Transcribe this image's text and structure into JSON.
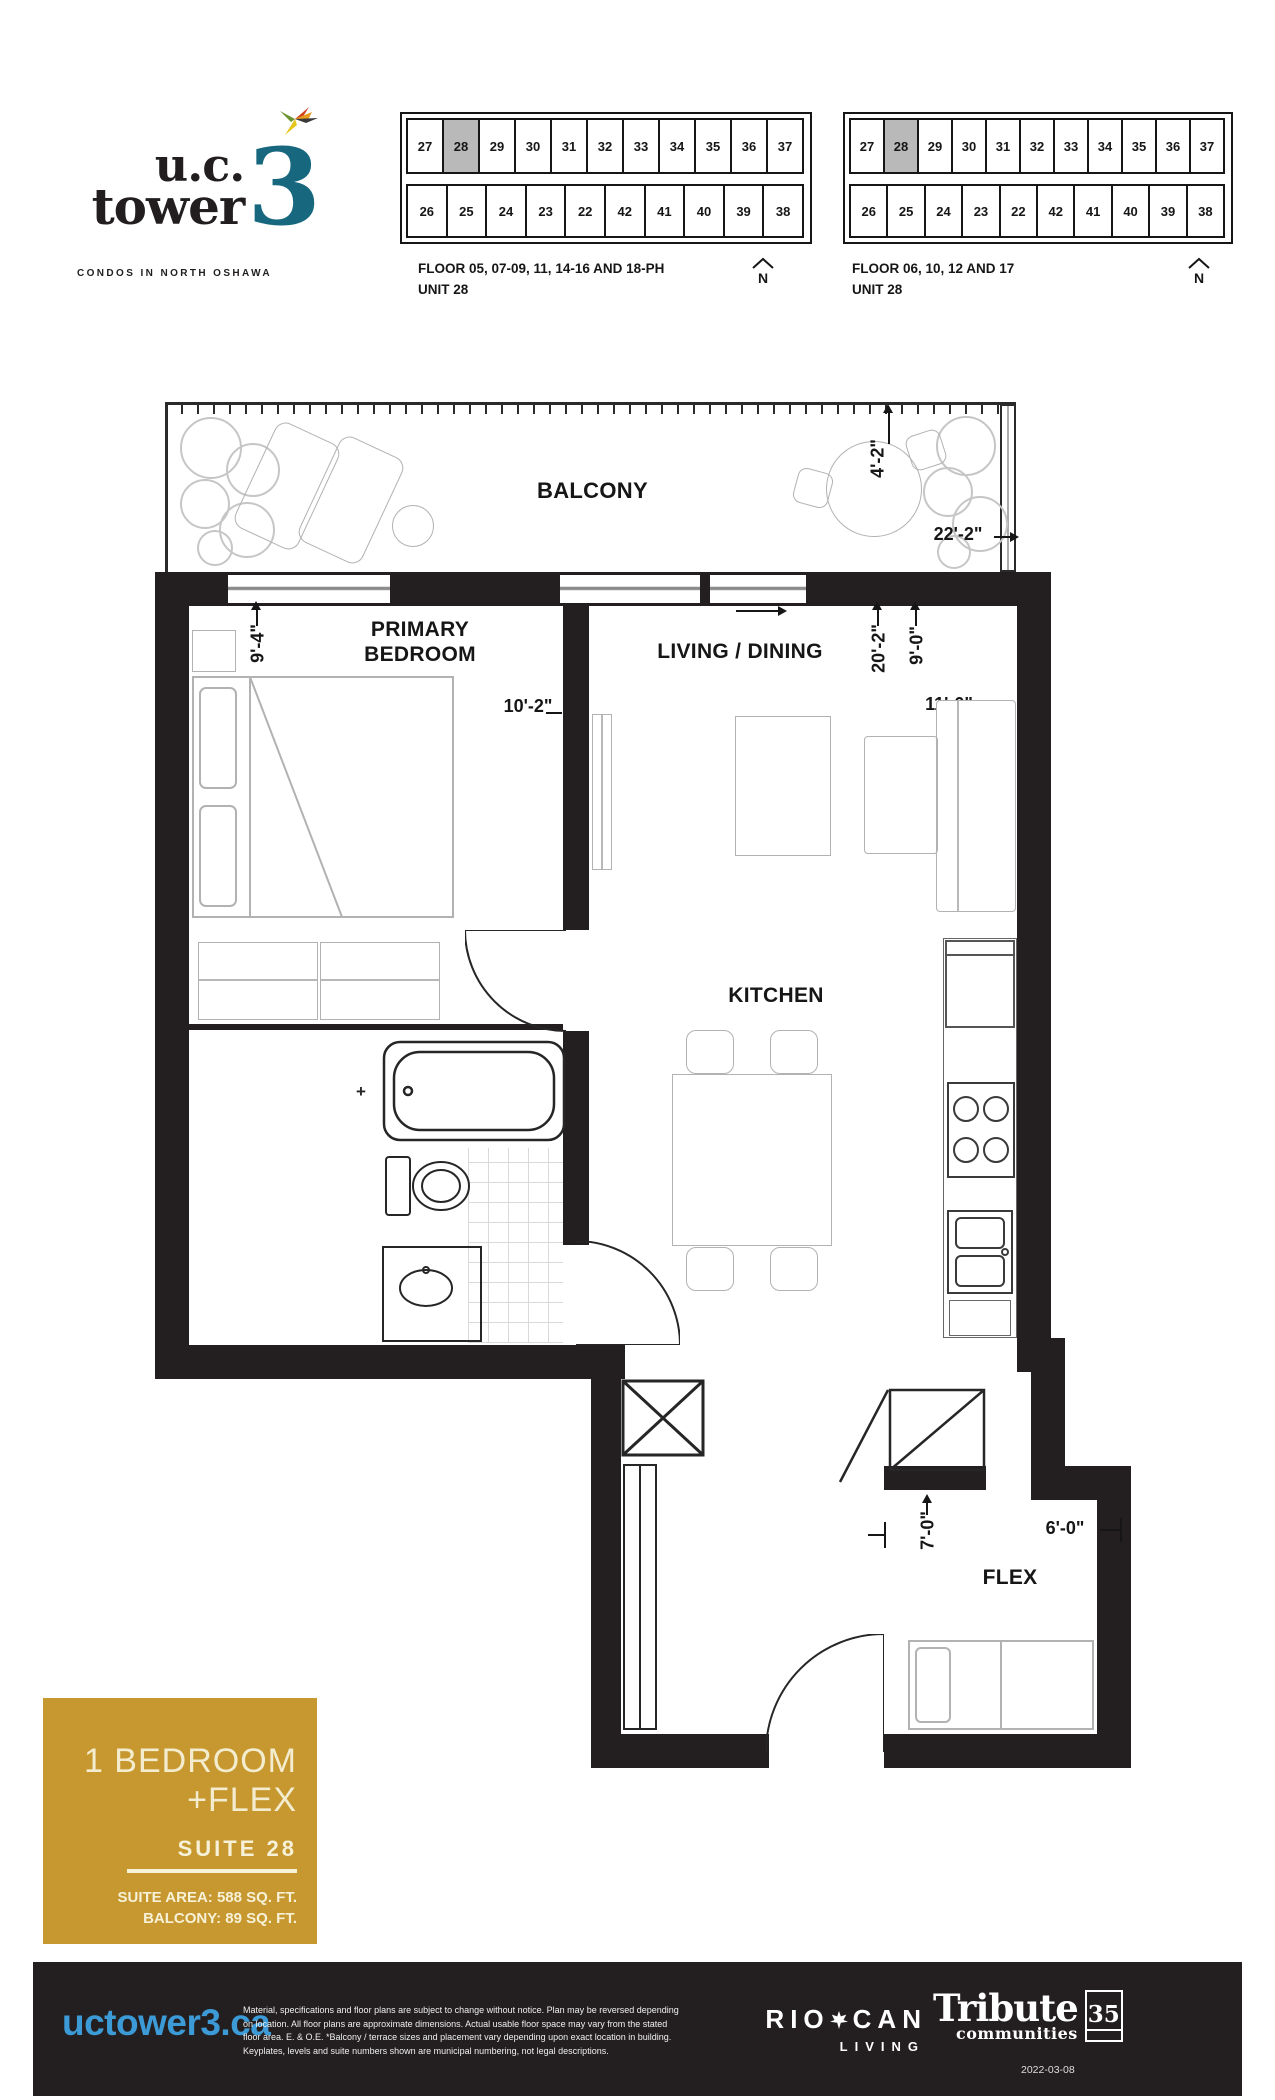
{
  "brand": {
    "name_line1": "u.c.",
    "name_line2": "tower",
    "name_number": "3",
    "tagline": "CONDOS IN NORTH OSHAWA"
  },
  "keyplates": [
    {
      "floors": "FLOOR 05, 07-09, 11, 14-16 AND 18-PH",
      "unit": "UNIT 28",
      "north": "N",
      "highlighted": "28",
      "top_units": [
        "27",
        "28",
        "29",
        "30",
        "31",
        "32",
        "33",
        "34",
        "35",
        "36",
        "37"
      ],
      "bottom_units": [
        "26",
        "25",
        "24",
        "23",
        "22",
        "42",
        "41",
        "40",
        "39",
        "38"
      ]
    },
    {
      "floors": "FLOOR 06, 10, 12 AND 17",
      "unit": "UNIT 28",
      "north": "N",
      "highlighted": "28",
      "top_units": [
        "27",
        "28",
        "29",
        "30",
        "31",
        "32",
        "33",
        "34",
        "35",
        "36",
        "37"
      ],
      "bottom_units": [
        "26",
        "25",
        "24",
        "23",
        "22",
        "42",
        "41",
        "40",
        "39",
        "38"
      ]
    }
  ],
  "plan": {
    "labels": {
      "balcony": "BALCONY",
      "bedroom": "PRIMARY BEDROOM",
      "living": "LIVING / DINING",
      "kitchen": "KITCHEN",
      "flex": "FLEX"
    },
    "dims": {
      "balcony_depth": "4'-2\"",
      "balcony_width": "22'-2\"",
      "bedroom_width": "9'-4\"",
      "bedroom_length": "10'-2\"",
      "living_length": "20'-2\"",
      "living_width": "9'-0\"",
      "living_width_2": "11'-0\"",
      "flex_depth": "7'-0\"",
      "flex_width": "6'-0\""
    },
    "tap_symbol": "+"
  },
  "suite": {
    "type_line1": "1 BEDROOM",
    "type_line2": "+FLEX",
    "suite_label": "SUITE 28",
    "area": "SUITE AREA: 588 SQ. FT.",
    "balcony_area": "BALCONY: 89 SQ. FT."
  },
  "footer": {
    "website": "uctower3.ca",
    "legal": [
      "Material, specifications and floor plans are subject to change without notice.  Plan may be reversed depending",
      "on location. All floor plans are approximate dimensions. Actual usable floor space may vary from the stated",
      "floor area. E. & O.E. *Balcony / terrace sizes and placement vary depending upon exact location in building.",
      "Keyplates, levels and suite numbers shown are municipal numbering, not legal descriptions."
    ],
    "riocan_rio": "RIO",
    "riocan_can": "CAN",
    "riocan_living": "LIVING",
    "tribute_name": "Tribute",
    "tribute_sub": "communities",
    "tribute_badge": "35",
    "date": "2022-03-08"
  },
  "colors": {
    "wall_black": "#231f20",
    "keyplate_highlight": "#b9b9b9",
    "logo_teal": "#17687E",
    "suite_box_gold": "#C6982F",
    "suite_box_text": "#F3ECCF",
    "website_blue": "#3C9AD6",
    "footer_bg": "#231f20"
  }
}
